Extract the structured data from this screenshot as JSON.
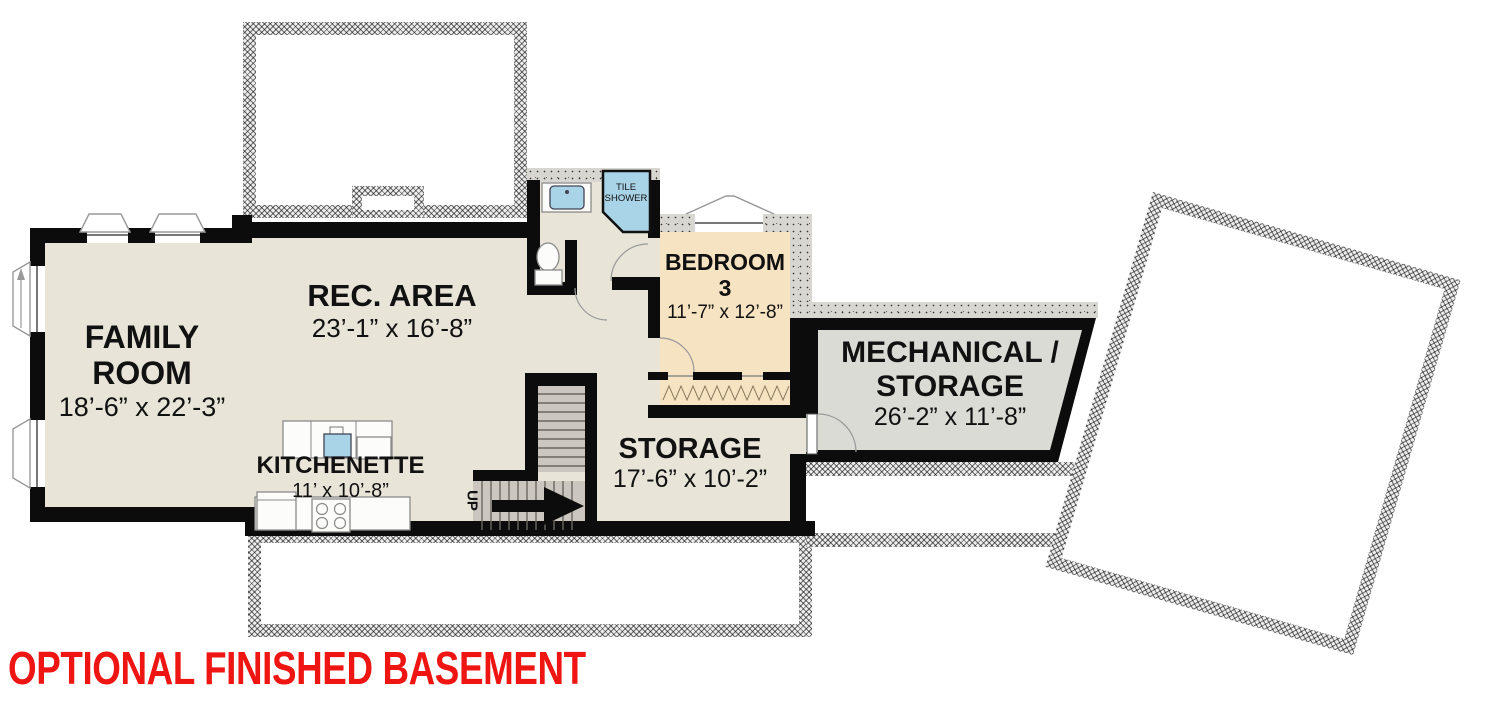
{
  "title": {
    "text": "OPTIONAL FINISHED BASEMENT"
  },
  "rooms": {
    "family_room": {
      "line1": "FAMILY",
      "line2": "ROOM",
      "dims": "18’-6” x 22’-3”"
    },
    "rec_area": {
      "name": "REC. AREA",
      "dims": "23’-1” x 16’-8”"
    },
    "kitchenette": {
      "name": "KITCHENETTE",
      "dims": "11’ x 10’-8”"
    },
    "storage": {
      "name": "STORAGE",
      "dims": "17’-6” x 10’-2”"
    },
    "bedroom_3": {
      "line1": "BEDROOM",
      "line2": "3",
      "dims": "11’-7” x 12’-8”"
    },
    "mechanical_storage": {
      "line1": "MECHANICAL /",
      "line2": "STORAGE",
      "dims": "26’-2” x 11’-8”"
    },
    "bath": {
      "shower_line1": "TILE",
      "shower_line2": "SHOWER"
    },
    "stairs": {
      "direction_label": "UP"
    }
  },
  "colors": {
    "floor_beige": "#e8e4d8",
    "bedroom_tan": "#f6e3c2",
    "mechanical_gray": "#dbdbd6",
    "stair_gray": "#cbc7c0",
    "wall_black": "#0c0c0c",
    "fixture_blue": "#a9d3e6",
    "title_red": "#ee1512"
  }
}
